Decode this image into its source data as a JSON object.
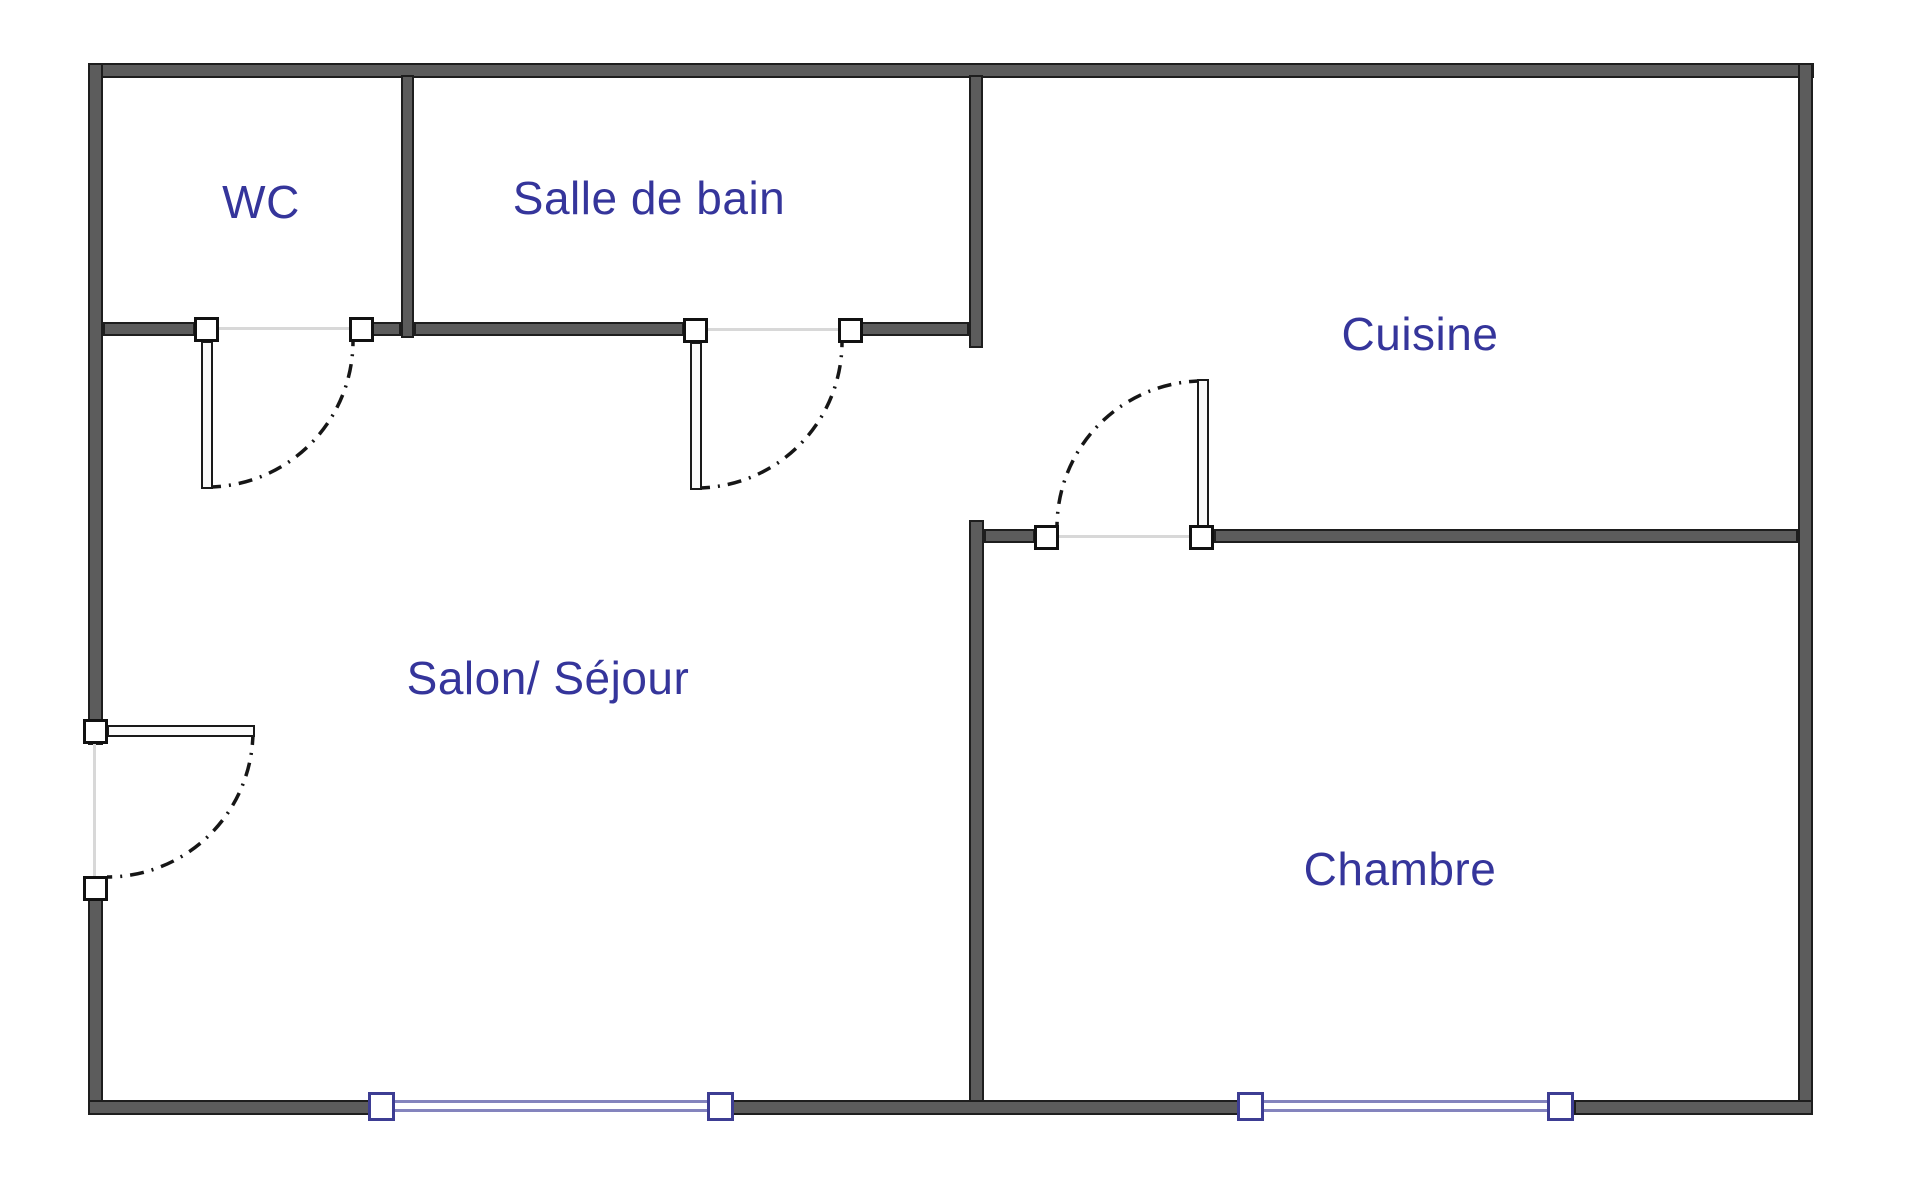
{
  "plan": {
    "type": "apartment-floor-plan",
    "background": "#ffffff",
    "rooms": [
      {
        "name": "WC"
      },
      {
        "name": "Salle de bain"
      },
      {
        "name": "Cuisine"
      },
      {
        "name": "Salon/ Séjour"
      },
      {
        "name": "Chambre"
      }
    ],
    "doors": [
      {
        "room": "WC",
        "type": "swing-door"
      },
      {
        "room": "Salle de bain",
        "type": "swing-door"
      },
      {
        "room": "Cuisine",
        "type": "swing-door"
      },
      {
        "room": "Salon/ Séjour",
        "type": "swing-door-entry"
      }
    ],
    "windows": [
      {
        "room": "Salon/ Séjour",
        "wall": "bottom"
      },
      {
        "room": "Chambre",
        "wall": "bottom"
      }
    ],
    "colors": {
      "wall_fill": "#5c5c5c",
      "wall_outline": "#1e1e1e",
      "label_text": "#35359b",
      "window_glass": "#8484bd",
      "window_frame": "#3d3d93",
      "door_arc": "#161616",
      "opening_line": "#d8d8d8"
    }
  }
}
